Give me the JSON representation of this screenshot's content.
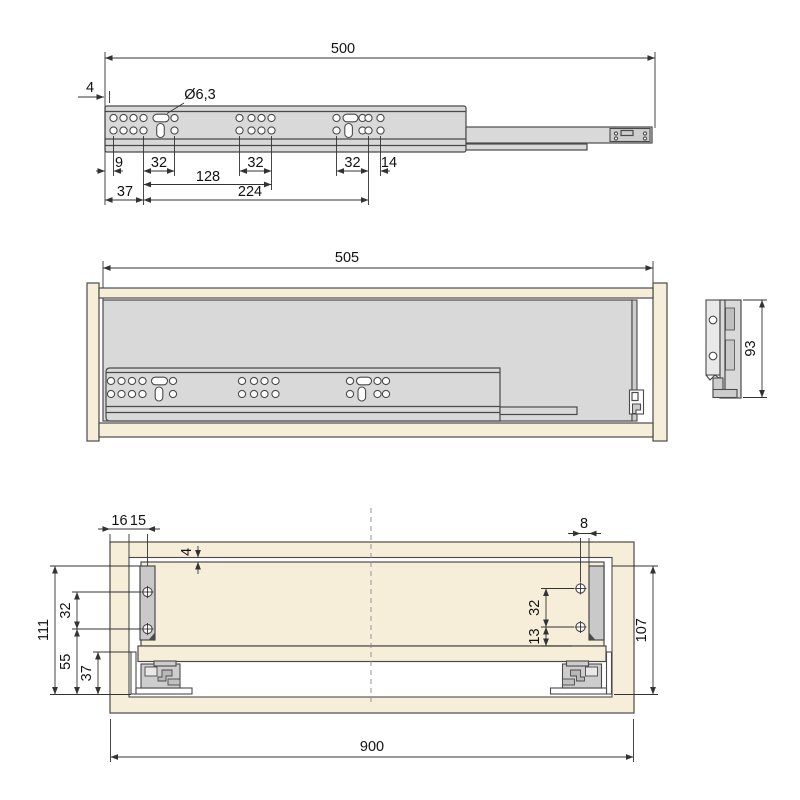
{
  "drawing": {
    "colors": {
      "wood": "#f6eed9",
      "metal": "#d9d9d9",
      "bracket": "#c9c9c9",
      "line": "#4a4a4a",
      "dim_text": "#111111"
    },
    "views": {
      "top": {
        "length": "500",
        "front_offset": "4",
        "hole_dia": "Ø6,3",
        "d9": "9",
        "d32a": "32",
        "d32b": "32",
        "d32c": "32",
        "d14": "14",
        "d128": "128",
        "d37": "37",
        "d224": "224"
      },
      "middle": {
        "length": "505",
        "height": "93"
      },
      "bottom": {
        "d16": "16",
        "d15": "15",
        "gap4": "4",
        "d8": "8",
        "left32": "32",
        "d111": "111",
        "d55": "55",
        "d37": "37",
        "right32": "32",
        "d13": "13",
        "d107": "107",
        "width": "900"
      }
    }
  }
}
